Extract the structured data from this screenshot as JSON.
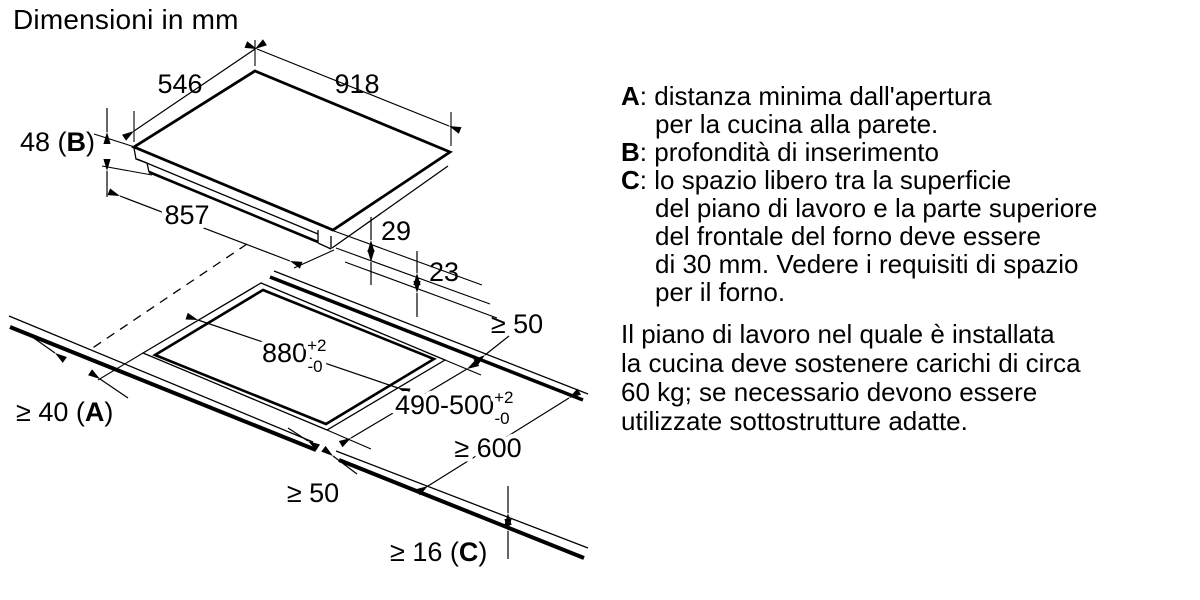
{
  "title": "Dimensioni in mm",
  "diagram": {
    "unit_note": "mm",
    "hob": {
      "depth": "546",
      "width": "918",
      "insert_height_pre": "48 (",
      "insert_height_letter": "B",
      "insert_height_post": ")",
      "base_width": "857",
      "front_offset_1": "29",
      "front_offset_2": "23"
    },
    "cutout": {
      "length": "880",
      "length_tol_plus": "+2",
      "length_tol_minus": "-0",
      "depth": "490-500",
      "depth_tol_plus": "+2",
      "depth_tol_minus": "-0",
      "side_clearance": "≥ 50",
      "front_clearance": "≥ 50",
      "wall_clearance_pre": "≥ 40 (",
      "wall_clearance_letter": "A",
      "wall_clearance_post": ")",
      "worktop_depth": "≥ 600",
      "worktop_thickness_pre": "≥ 16 (",
      "worktop_thickness_letter": "C",
      "worktop_thickness_post": ")"
    }
  },
  "legend": {
    "sep": ":",
    "items": [
      {
        "letter": "A",
        "lines": [
          "distanza minima dall'apertura",
          "per la cucina alla parete."
        ]
      },
      {
        "letter": "B",
        "lines": [
          "profondità di inserimento"
        ]
      },
      {
        "letter": "C",
        "lines": [
          "lo spazio libero tra la superficie",
          "del piano di lavoro e la parte superiore",
          "del frontale del forno deve essere",
          "di 30 mm. Vedere i requisiti di spazio",
          "per il forno."
        ]
      }
    ]
  },
  "note": {
    "lines": [
      "Il piano di lavoro nel quale è installata",
      "la cucina deve sostenere carichi di circa",
      "60 kg; se necessario devono essere",
      "utilizzate sottostrutture adatte."
    ]
  }
}
